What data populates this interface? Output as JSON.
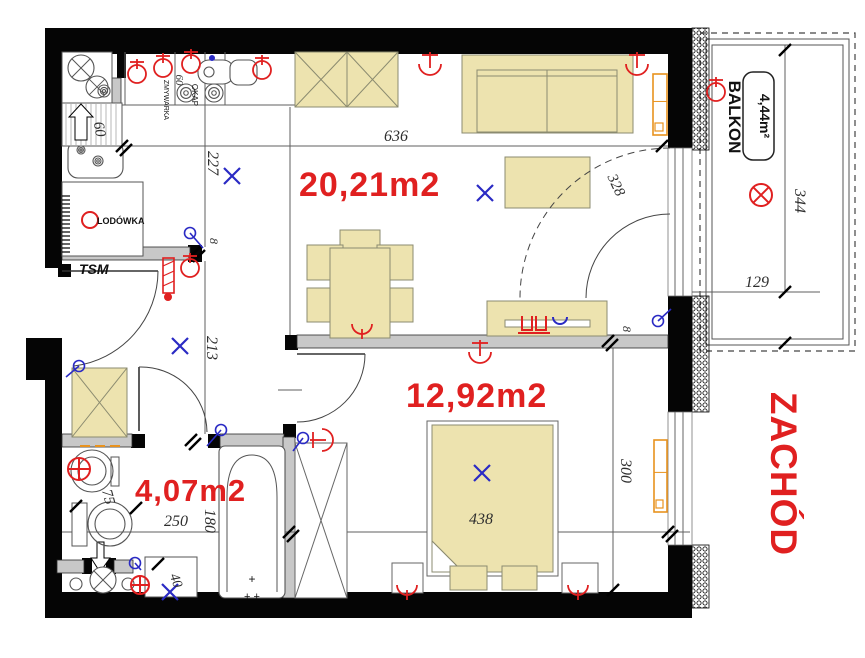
{
  "meta": {
    "width": 865,
    "height": 658,
    "background": "#ffffff"
  },
  "palette": {
    "wall": "#050505",
    "gray_wall": "#c8c8c8",
    "gray_wall_stroke": "#2b2b2b",
    "beige": "#EDE3AF",
    "beige_stroke": "#8b8b70",
    "thin_line": "#5f5f5f",
    "red": "#e02020",
    "blue": "#2a2ac4",
    "orange": "#e8921e",
    "fixture": "#555555"
  },
  "texts": {
    "areas": [
      {
        "room": "living-kitchen",
        "label": "20,21m2",
        "x": 299,
        "y": 196,
        "fs": 34
      },
      {
        "room": "bedroom",
        "label": "12,92m2",
        "x": 406,
        "y": 407,
        "fs": 34
      },
      {
        "room": "bathroom",
        "label": "4,07m2",
        "x": 135,
        "y": 501,
        "fs": 31
      }
    ],
    "zachod": {
      "label": "ZACHÓD",
      "x": 771,
      "y": 474,
      "fs": 37
    },
    "balkon": {
      "label": "BALKON",
      "x": 729,
      "y": 117,
      "fs": 17
    },
    "balkon_area": {
      "label": "4,44m²",
      "x": 760,
      "y": 116,
      "fs": 14
    },
    "tsm": {
      "label": "TSM",
      "x": 79,
      "y": 274,
      "fs": 14
    },
    "lodowka": {
      "label": "LODÓWKA",
      "x": 97,
      "y": 224,
      "fs": 9
    },
    "zmywarka": {
      "label": "ZMYWARKA",
      "x": 164,
      "y": 100,
      "fs": 7
    },
    "zm60": {
      "label": "60",
      "x": 176,
      "y": 80,
      "fs": 11
    },
    "okap": {
      "label": "OKAP",
      "x": 192,
      "y": 95,
      "fs": 8
    },
    "tub_plus1": {
      "label": "+",
      "x": 252,
      "y": 583,
      "fs": 12
    },
    "tub_plus2": {
      "label": "+ +",
      "x": 252,
      "y": 600,
      "fs": 11
    }
  },
  "dims": [
    {
      "t": "636",
      "x": 396,
      "y": 141,
      "r": 0,
      "fs": 16
    },
    {
      "t": "227",
      "x": 208,
      "y": 163,
      "r": 90,
      "fs": 16
    },
    {
      "t": "213",
      "x": 207,
      "y": 348,
      "r": 90,
      "fs": 16
    },
    {
      "t": "8",
      "x": 210,
      "y": 241,
      "r": 90,
      "fs": 12
    },
    {
      "t": "8",
      "x": 623,
      "y": 329,
      "r": 90,
      "fs": 12
    },
    {
      "t": "60",
      "x": 95,
      "y": 130,
      "r": 80,
      "fs": 15
    },
    {
      "t": "75",
      "x": 104,
      "y": 498,
      "r": 75,
      "fs": 15
    },
    {
      "t": "250",
      "x": 176,
      "y": 526,
      "r": 0,
      "fs": 16
    },
    {
      "t": "180",
      "x": 205,
      "y": 521,
      "r": 90,
      "fs": 16
    },
    {
      "t": "40",
      "x": 172,
      "y": 582,
      "r": 70,
      "fs": 14
    },
    {
      "t": "438",
      "x": 481,
      "y": 524,
      "r": 0,
      "fs": 16
    },
    {
      "t": "300",
      "x": 621,
      "y": 471,
      "r": 90,
      "fs": 16
    },
    {
      "t": "344",
      "x": 795,
      "y": 201,
      "r": 90,
      "fs": 16
    },
    {
      "t": "129",
      "x": 757,
      "y": 287,
      "r": 0,
      "fs": 16
    },
    {
      "t": "328",
      "x": 612,
      "y": 187,
      "r": 65,
      "fs": 15
    }
  ],
  "geometry": {
    "black_rects": [
      [
        45,
        28,
        647,
        26
      ],
      [
        45,
        28,
        17,
        240
      ],
      [
        45,
        352,
        17,
        266
      ],
      [
        26,
        338,
        36,
        42
      ],
      [
        45,
        592,
        645,
        26
      ],
      [
        668,
        28,
        24,
        122
      ],
      [
        668,
        296,
        24,
        116
      ],
      [
        668,
        545,
        24,
        73
      ],
      [
        117,
        52,
        9,
        26
      ],
      [
        188,
        245,
        14,
        17
      ],
      [
        131,
        434,
        14,
        14
      ],
      [
        208,
        434,
        12,
        14
      ],
      [
        283,
        424,
        13,
        14
      ],
      [
        285,
        335,
        13,
        15
      ],
      [
        58,
        264,
        13,
        13
      ],
      [
        82,
        558,
        10,
        16
      ],
      [
        106,
        558,
        10,
        16
      ],
      [
        669,
        140,
        10,
        9
      ]
    ],
    "gray_rects": [
      [
        62,
        247,
        128,
        13
      ],
      [
        62,
        434,
        70,
        13
      ],
      [
        220,
        434,
        64,
        13
      ],
      [
        283,
        437,
        12,
        161
      ],
      [
        297,
        335,
        371,
        13
      ],
      [
        57,
        560,
        27,
        13
      ],
      [
        114,
        560,
        19,
        13
      ],
      [
        112,
        78,
        9,
        27
      ]
    ],
    "hatch_rects": [
      [
        692,
        28,
        17,
        122
      ],
      [
        692,
        296,
        17,
        116
      ],
      [
        692,
        545,
        17,
        63
      ]
    ],
    "white_openings": [
      [
        668,
        148,
        24,
        148
      ],
      [
        668,
        412,
        24,
        133
      ]
    ],
    "frame_lines": [
      [
        675,
        148,
        675,
        296
      ],
      [
        683,
        148,
        683,
        296
      ],
      [
        675,
        412,
        675,
        545
      ],
      [
        683,
        412,
        683,
        545
      ]
    ],
    "balcony": {
      "outer": [
        700,
        33,
        155,
        318
      ],
      "mid": [
        706,
        39,
        143,
        306
      ],
      "inner": [
        712,
        45,
        131,
        294
      ]
    },
    "thin_lines": [
      [
        62,
        105,
        295,
        105
      ],
      [
        125,
        52,
        125,
        105
      ],
      [
        175,
        52,
        175,
        105
      ],
      [
        225,
        52,
        225,
        105
      ],
      [
        295,
        52,
        295,
        105
      ],
      [
        290,
        107,
        290,
        335
      ],
      [
        62,
        146,
        668,
        146
      ],
      [
        205,
        52,
        205,
        247
      ],
      [
        205,
        261,
        205,
        434
      ],
      [
        122,
        103,
        122,
        146
      ],
      [
        62,
        532,
        690,
        532
      ],
      [
        613,
        348,
        613,
        592
      ],
      [
        785,
        45,
        785,
        292
      ],
      [
        692,
        292,
        820,
        292
      ],
      [
        278,
        390,
        302,
        390
      ]
    ],
    "beige_xboxes": [
      [
        295,
        52,
        52,
        55
      ],
      [
        347,
        52,
        51,
        55
      ],
      [
        72,
        368,
        55,
        69
      ]
    ],
    "white_xboxes": [
      [
        295,
        443,
        52,
        155
      ]
    ],
    "chairs": [
      [
        340,
        230,
        40,
        19
      ],
      [
        307,
        245,
        36,
        35
      ],
      [
        377,
        245,
        36,
        35
      ],
      [
        307,
        288,
        36,
        34
      ],
      [
        377,
        288,
        36,
        34
      ]
    ],
    "table": [
      330,
      248,
      60,
      90
    ],
    "sofa": {
      "outer": [
        462,
        55,
        171,
        78
      ],
      "inner": [
        477,
        70,
        140,
        62
      ],
      "back": [
        477,
        76,
        617,
        76
      ],
      "div": [
        547,
        70,
        547,
        132
      ]
    },
    "coffee_table": [
      505,
      157,
      85,
      51
    ],
    "dresser": {
      "body": [
        487,
        301,
        120,
        35
      ],
      "slot": [
        505,
        320,
        85,
        7
      ]
    },
    "bed": {
      "frame": [
        427,
        421,
        131,
        155
      ],
      "mattress": [
        [
          432,
          425
        ],
        [
          553,
          425
        ],
        [
          553,
          572
        ],
        [
          463,
          572
        ],
        [
          432,
          541
        ]
      ],
      "fold": [
        [
          432,
          541
        ],
        [
          463,
          572
        ],
        [
          432,
          572
        ]
      ]
    },
    "pillows": [
      [
        450,
        566,
        37,
        24
      ],
      [
        502,
        566,
        35,
        24
      ]
    ],
    "nightstands": [
      [
        392,
        563,
        31,
        30
      ],
      [
        562,
        563,
        36,
        30
      ]
    ],
    "stroke_rects": [
      [
        62,
        52,
        50,
        53
      ],
      [
        62,
        182,
        81,
        74
      ],
      [
        72,
        503,
        15,
        43
      ],
      [
        111,
        457,
        8,
        29
      ],
      [
        145,
        557,
        52,
        40
      ]
    ],
    "round_rects": [
      [
        198,
        60,
        36,
        24,
        11
      ],
      [
        230,
        60,
        27,
        25,
        8
      ],
      [
        68,
        141,
        55,
        37,
        10
      ],
      [
        219,
        446,
        66,
        152,
        6
      ]
    ],
    "tub_arch": "M227,592 L227,497 Q227,455 252,455 Q277,455 277,497 L277,592",
    "shaft": {
      "rect": [
        62,
        103,
        60,
        43
      ],
      "hatch_step": 5,
      "arrow": [
        [
          75,
          140
        ],
        [
          75,
          117
        ],
        [
          69,
          117
        ],
        [
          81,
          104
        ],
        [
          93,
          117
        ],
        [
          87,
          117
        ],
        [
          87,
          140
        ]
      ]
    },
    "fridge_comb": {
      "x1": 62,
      "x2": 70,
      "y1": 196,
      "y2": 252,
      "step": 4
    },
    "toilet_arrow": [
      [
        97,
        542
      ],
      [
        104,
        542
      ],
      [
        104,
        558
      ],
      [
        110,
        558
      ],
      [
        100,
        572
      ],
      [
        91,
        558
      ],
      [
        97,
        558
      ]
    ],
    "crossed_circles": [
      [
        81,
        68,
        13
      ],
      [
        97,
        87,
        11
      ],
      [
        103,
        580,
        13
      ]
    ],
    "rings": [
      [
        186,
        93,
        9
      ],
      [
        214,
        93,
        9
      ],
      [
        104,
        91,
        6
      ],
      [
        81,
        150,
        4
      ],
      [
        98,
        161,
        5
      ]
    ],
    "plain_circles": [
      [
        92,
        471,
        21
      ],
      [
        92,
        471,
        14
      ],
      [
        110,
        524,
        22
      ],
      [
        110,
        524,
        15
      ],
      [
        76,
        584,
        6
      ],
      [
        128,
        584,
        6
      ],
      [
        209,
        72,
        5
      ]
    ],
    "radiators": [
      [
        653,
        74,
        14,
        61
      ],
      [
        654,
        440,
        13,
        72
      ]
    ],
    "orange_dashes": [
      [
        80,
        446,
        90,
        446
      ],
      [
        95,
        446,
        105,
        446
      ],
      [
        110,
        446,
        120,
        446
      ]
    ],
    "doors": {
      "leaves": [
        [
          62,
          271,
          158,
          271
        ],
        [
          139,
          367,
          139,
          431
        ],
        [
          297,
          354,
          365,
          354
        ]
      ],
      "arcs": [
        {
          "d": "M158,271 A96,96 0 0 1 74,366",
          "dash": ""
        },
        {
          "d": "M139,367 A66,66 0 0 1 207,432",
          "dash": ""
        },
        {
          "d": "M365,354 A68,68 0 0 1 297,422",
          "dash": ""
        },
        {
          "d": "M670,214 A84,84 0 0 0 586,298",
          "dash": ""
        },
        {
          "d": "M670,148 A150,150 0 0 0 520,298",
          "dash": "7 5"
        }
      ]
    },
    "ticks": [
      [
        122,
        146,
        1
      ],
      [
        195,
        252,
        1
      ],
      [
        191,
        440,
        1
      ],
      [
        289,
        532,
        1
      ],
      [
        668,
        532,
        1
      ],
      [
        608,
        341,
        1
      ],
      [
        662,
        146,
        0
      ],
      [
        785,
        50,
        0
      ],
      [
        785,
        292,
        0
      ],
      [
        785,
        343,
        0
      ],
      [
        613,
        590,
        0
      ],
      [
        158,
        564,
        0
      ],
      [
        76,
        506,
        0
      ],
      [
        136,
        508,
        0
      ]
    ],
    "symbols": {
      "blue_x": [
        [
          232,
          176
        ],
        [
          485,
          193
        ],
        [
          180,
          346
        ],
        [
          482,
          473
        ],
        [
          170,
          592
        ]
      ],
      "switches": [
        [
          190,
          233,
          203,
          248
        ],
        [
          658,
          321,
          671,
          309
        ],
        [
          221,
          430,
          207,
          446
        ],
        [
          303,
          438,
          293,
          451
        ],
        [
          79,
          366,
          66,
          377
        ],
        [
          135,
          563,
          141,
          570
        ]
      ],
      "blue_dots": [
        [
          212,
          58,
          3
        ]
      ],
      "red_wall_lamps": [
        [
          137,
          74
        ],
        [
          163,
          68
        ],
        [
          191,
          64
        ],
        [
          262,
          70
        ],
        [
          190,
          268
        ],
        [
          716,
          92
        ]
      ],
      "red_ceiling_lamps": [
        [
          430,
          64,
          0
        ],
        [
          637,
          64,
          0
        ],
        [
          480,
          352,
          0
        ],
        [
          322,
          440,
          -90
        ]
      ],
      "red_y_lamps": [
        [
          362,
          330
        ],
        [
          407,
          591
        ],
        [
          578,
          591
        ]
      ],
      "red_circle_symbols": [
        [
          761,
          195,
          11,
          "x"
        ],
        [
          79,
          469,
          11,
          "+"
        ],
        [
          140,
          585,
          9,
          "+"
        ],
        [
          90,
          220,
          8,
          ""
        ]
      ],
      "riser": {
        "rect": [
          163,
          258,
          11,
          35
        ],
        "dot": [
          168,
          297,
          4
        ]
      },
      "tv_outlets": {
        "u1": [
          522,
          316,
          10,
          14
        ],
        "u2": [
          536,
          316,
          10,
          14
        ],
        "bar": [
          518,
          333,
          550,
          333
        ],
        "blue_u": [
          553,
          317,
          567,
          317
        ]
      }
    },
    "balkon_box": [
      743,
      72,
      31,
      88
    ]
  }
}
